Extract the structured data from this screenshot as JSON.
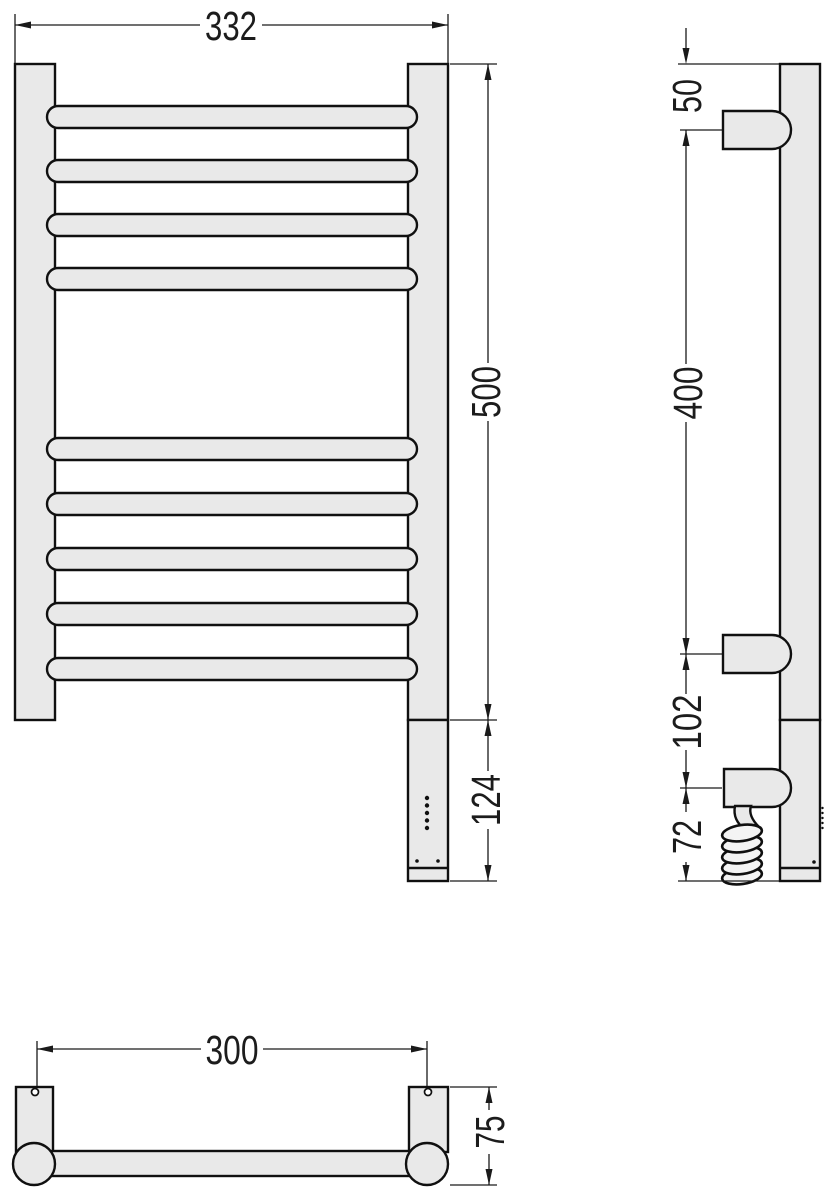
{
  "colors": {
    "background": "#ffffff",
    "part_fill": "#e9e9e9",
    "coil_fill": "#f4f4f4",
    "outline": "#101010",
    "dimension": "#1a1a1a"
  },
  "front_view": {
    "overall_width": "332",
    "rail_height": "500",
    "heater_section_height": "124"
  },
  "side_view": {
    "top_to_upper_bracket": "50",
    "bracket_to_bracket": "400",
    "bracket_to_cable_entry": "102",
    "cable_entry_to_bottom": "72"
  },
  "bottom_view": {
    "bracket_hole_spacing": "300",
    "wall_to_front_depth": "75"
  }
}
